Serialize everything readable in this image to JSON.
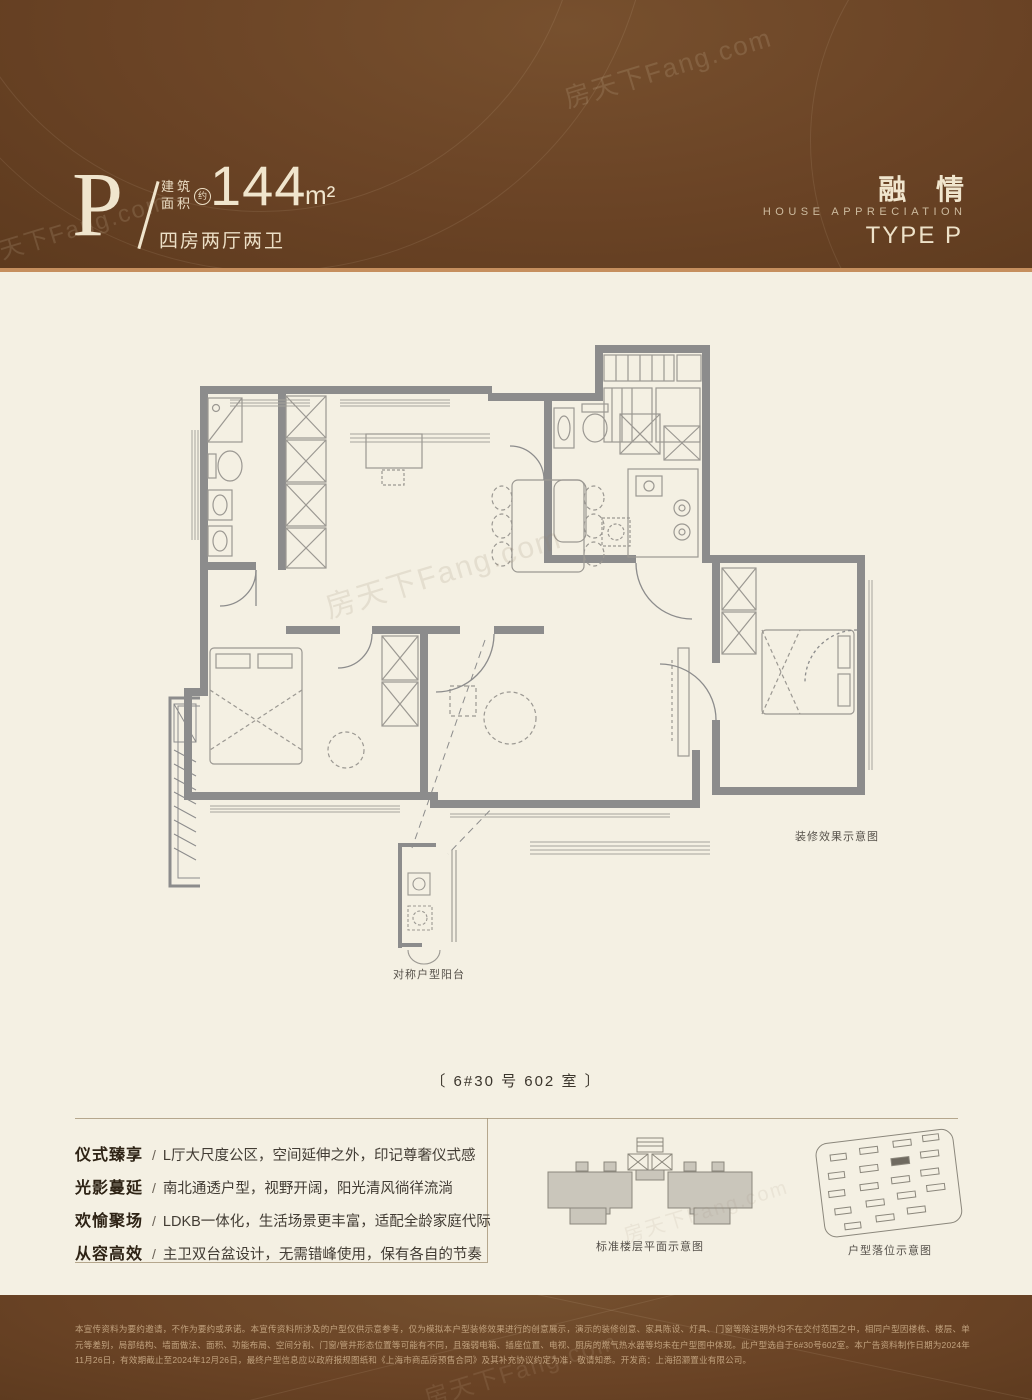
{
  "watermark": "房天下Fang.com",
  "header": {
    "type_letter": "P",
    "area_label_top": "建筑",
    "area_label_bottom": "面积",
    "approx": "约",
    "area_value": "144",
    "area_unit": "m²",
    "layout": "四房两厅两卫",
    "brand_cn": "融 情",
    "brand_en": "HOUSE APPRECIATION",
    "type_name": "TYPE P"
  },
  "plan": {
    "caption_decoration": "装修效果示意图",
    "caption_balcony": "对称户型阳台",
    "unit_label": "〔 6#30 号 602 室 〕"
  },
  "features": {
    "separator": "/",
    "items": [
      {
        "title": "仪式臻享",
        "desc": "L厅大尺度公区，空间延伸之外，印记尊奢仪式感"
      },
      {
        "title": "光影蔓延",
        "desc": "南北通透户型，视野开阔，阳光清风徜徉流淌"
      },
      {
        "title": "欢愉聚场",
        "desc": "LDKB一体化，生活场景更丰富，适配全龄家庭代际"
      },
      {
        "title": "从容高效",
        "desc": "主卫双台盆设计，无需错峰使用，保有各自的节奏"
      }
    ]
  },
  "diagrams": {
    "floorplate_caption": "标准楼层平面示意图",
    "siteplan_caption": "户型落位示意图"
  },
  "footer": {
    "line1": "本宣传资料为要约邀请，不作为要约或承诺。本宣传资料所涉及的户型仅供示意参考，仅为模拟本户型装修效果进行的创意展示，演示的装修创意、家具陈设、灯具、门窗等除注明外均不在交付范围之中，相同户型因楼栋、楼层、单元等差别，局部结构、墙面",
    "line2": "做法、面积、功能布局、空间分割、门窗/管井形态位置等可能有不同，且强弱电箱、插座位置、电视、厨房的燃气热水器等均未在户型图中体现。此户型选自于6#30号602室。本广告资料制作日期为2024年11月26日，有效期截止至2024年12月26日，最终户型",
    "line3": "信息应以政府报规图纸和《上海市商品房预售合同》及其补充协议约定为准，敬请知悉。开发商：上海招灏置业有限公司。"
  },
  "colors": {
    "band_brown": "#6a4325",
    "tan_line": "#c68f5e",
    "cream": "#f4f0e3",
    "wall_gray": "#8c8c8c"
  }
}
